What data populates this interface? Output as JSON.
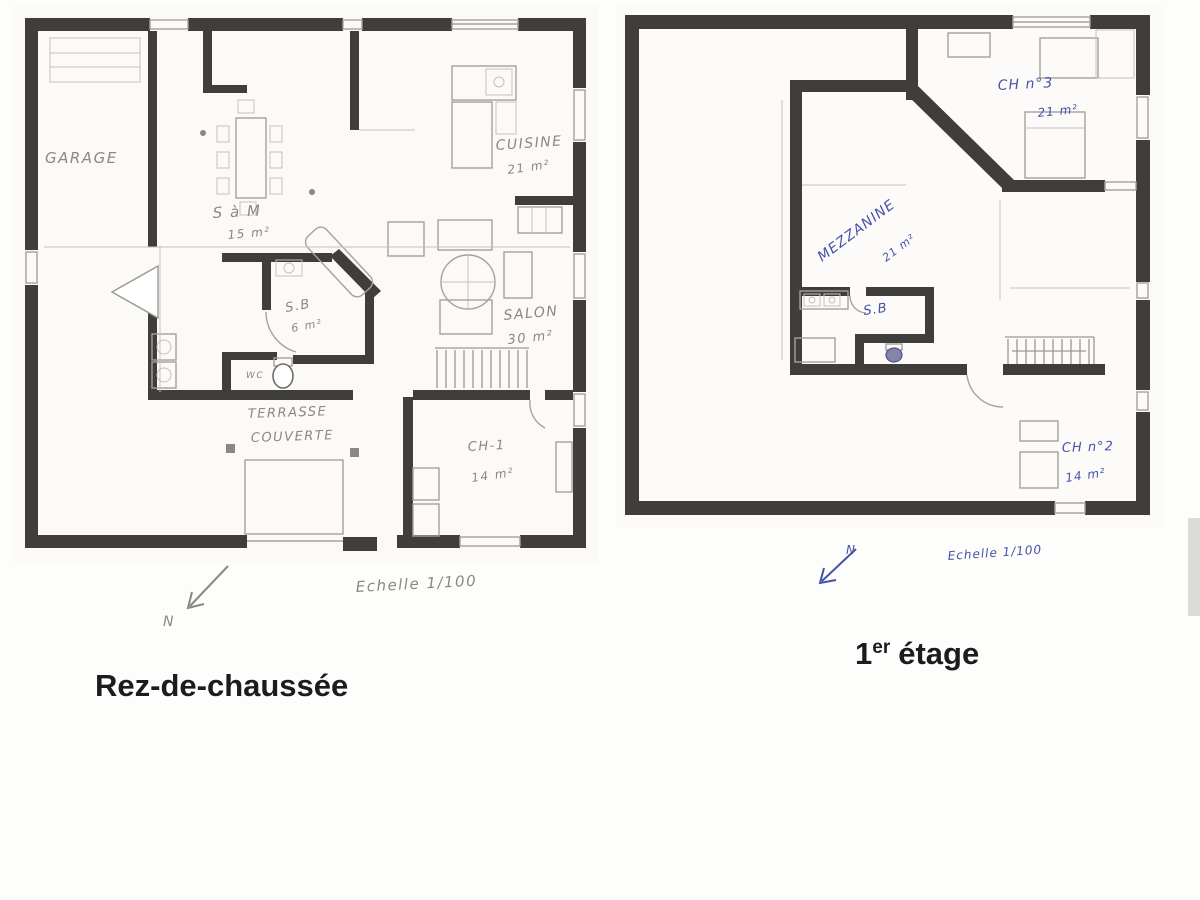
{
  "colors": {
    "wall": "#403e3a",
    "pencil_text": "#8b8883",
    "blue_ink": "#4453a6",
    "thin_line": "#a5a29c",
    "caption_text": "#1c1c1c"
  },
  "ground_floor": {
    "caption": "Rez-de-chaussée",
    "north_label": "N",
    "scale_label": "Echelle 1/100",
    "rooms": {
      "garage": {
        "label": "GARAGE"
      },
      "salle_a_manger": {
        "label": "S à M",
        "area": "15 m²"
      },
      "cuisine": {
        "label": "CUISINE",
        "area": "21 m²"
      },
      "salon": {
        "label": "SALON",
        "area": "30 m²"
      },
      "salle_de_bain": {
        "label": "S.B",
        "area": "6 m²"
      },
      "wc": {
        "label": "WC"
      },
      "terrasse": {
        "label_line1": "TERRASSE",
        "label_line2": "COUVERTE"
      },
      "chambre1": {
        "label": "CH-1",
        "area": "14 m²"
      }
    }
  },
  "first_floor": {
    "caption_base": "1",
    "caption_sup": "er",
    "caption_rest": "étage",
    "north_label": "N",
    "scale_label": "Echelle 1/100",
    "rooms": {
      "chambre3": {
        "label": "CH n°3",
        "area": "21 m²"
      },
      "mezzanine": {
        "label": "MEZZANINE",
        "area": "21 m²"
      },
      "salle_de_bain": {
        "label": "S.B"
      },
      "chambre2": {
        "label": "CH n°2",
        "area": "14 m²"
      }
    }
  }
}
